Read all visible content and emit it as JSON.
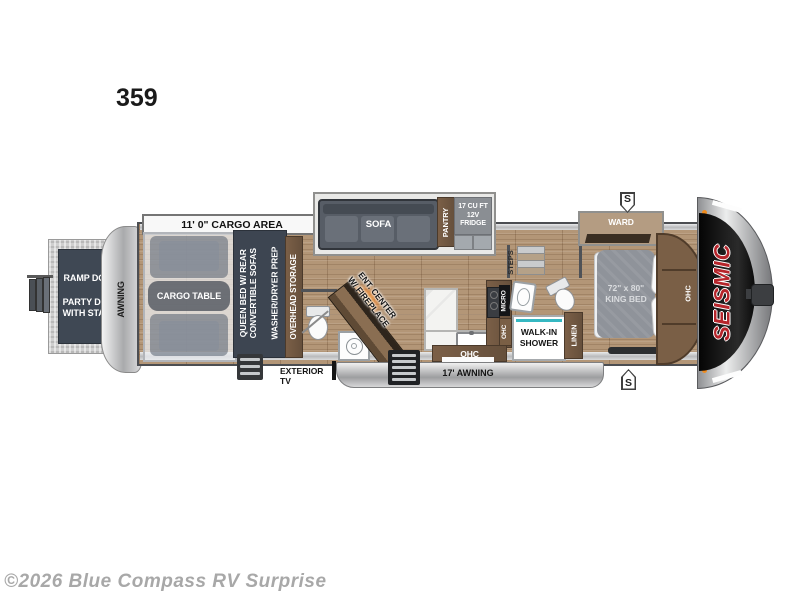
{
  "page": {
    "model_number": "359",
    "copyright": "©2026 Blue Compass RV Surprise"
  },
  "floorplan": {
    "labels": {
      "cargo_area": "11' 0\" CARGO AREA",
      "ramp_door": "RAMP DOOR",
      "party_deck_line1": "PARTY DECK",
      "party_deck_line2": "WITH STAIRS",
      "awning_rear": "AWNING",
      "cargo_table": "CARGO TABLE",
      "queen_bed_line1": "QUEEN BED W/ REAR",
      "queen_bed_line2": "CONVERTIBLE SOFAS",
      "washer_dryer": "WASHER/DRYER PREP",
      "overhead_storage": "OVERHEAD STORAGE",
      "sofa": "SOFA",
      "pantry": "PANTRY",
      "fridge_line1": "17 CU FT",
      "fridge_line2": "12V FRIDGE",
      "ent_center_line1": "ENT. CENTER",
      "ent_center_line2": "W/ FIREPLACE",
      "steps": "STEPS",
      "micro": "MICRO",
      "ohc_kitchen_vertical": "OHC",
      "ohc_kitchen_bottom": "OHC",
      "walk_in_shower_line1": "WALK-IN",
      "walk_in_shower_line2": "SHOWER",
      "linen": "LINEN",
      "ward": "WARD",
      "king_bed_line1": "72\" x 80\"",
      "king_bed_line2": "KING BED",
      "ohc_bedroom": "OHC",
      "brand": "SEISMIC",
      "exterior_tv": "EXTERIOR TV",
      "awning_front": "17' AWNING",
      "slide_badge": "S"
    },
    "colors": {
      "slate": "#3d4551",
      "wood_floor": "#b39677",
      "cabinet_brown": "#6e5440",
      "accent_teal": "#35b8c2",
      "brand_red": "#b6252b",
      "fire_orange": "#ffa726"
    }
  }
}
